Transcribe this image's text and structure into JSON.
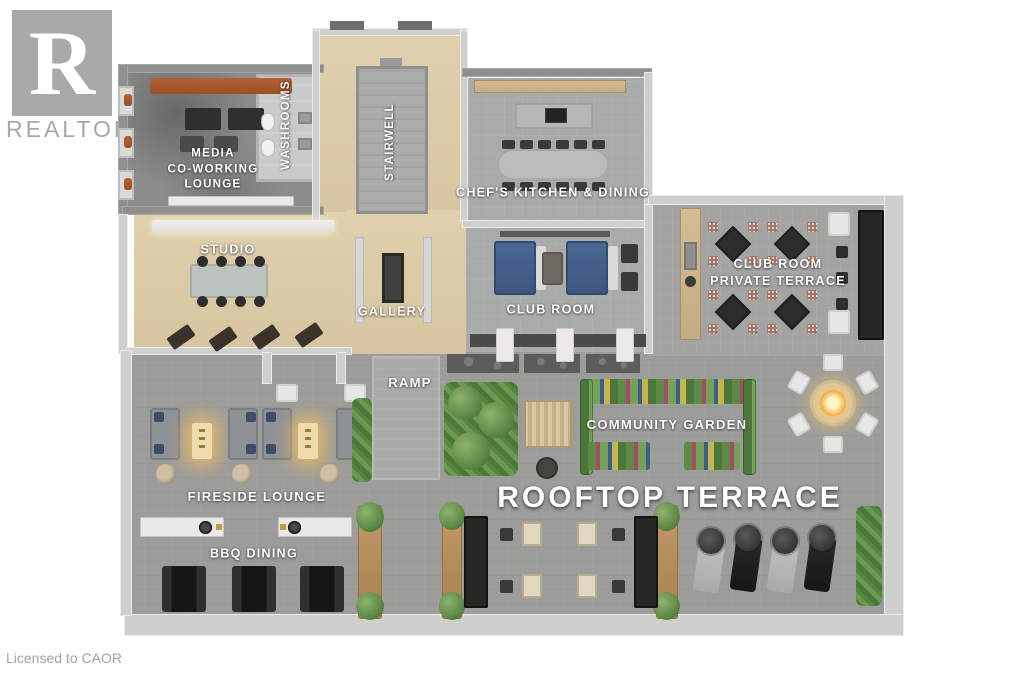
{
  "branding": {
    "logo_letter": "R",
    "brand_name": "REALTOR",
    "registered_mark": "®",
    "license_text": "Licensed to CAOR"
  },
  "plan": {
    "rooms": {
      "media_lounge": "MEDIA\nCO-WORKING\nLOUNGE",
      "washrooms": "WASHROOMS",
      "stairwell": "STAIRWELL",
      "chefs_kitchen": "CHEF'S KITCHEN & DINING",
      "studio": "STUDIO",
      "gallery": "GALLERY",
      "club_room": "CLUB ROOM",
      "club_room_private_terrace": "CLUB ROOM\nPRIVATE TERRACE",
      "ramp": "RAMP",
      "community_garden": "COMMUNITY GARDEN",
      "fireside_lounge": "FIRESIDE LOUNGE",
      "rooftop_terrace": "ROOFTOP TERRACE",
      "bbq_dining": "BBQ DINING"
    },
    "palette": {
      "background": "#ffffff",
      "terrace_floor": "#9c9c9a",
      "private_terrace_floor": "#a3a3a1",
      "interior_wood_floor": "#dccca9",
      "media_lounge_floor": "#8c8c8a",
      "kitchen_floor": "#a9aba8",
      "wall_light": "#cfcfcd",
      "wall_dark": "#8f8f8d",
      "label_text": "#ffffff",
      "sofa_orange": "#a85a2e",
      "sofa_blue": "#42608c",
      "plant_green": "#5d8a46",
      "wood_planter": "#b08a5e",
      "fire_glow": "#f2a93c",
      "logo_gray": "#a9a9a9"
    }
  }
}
